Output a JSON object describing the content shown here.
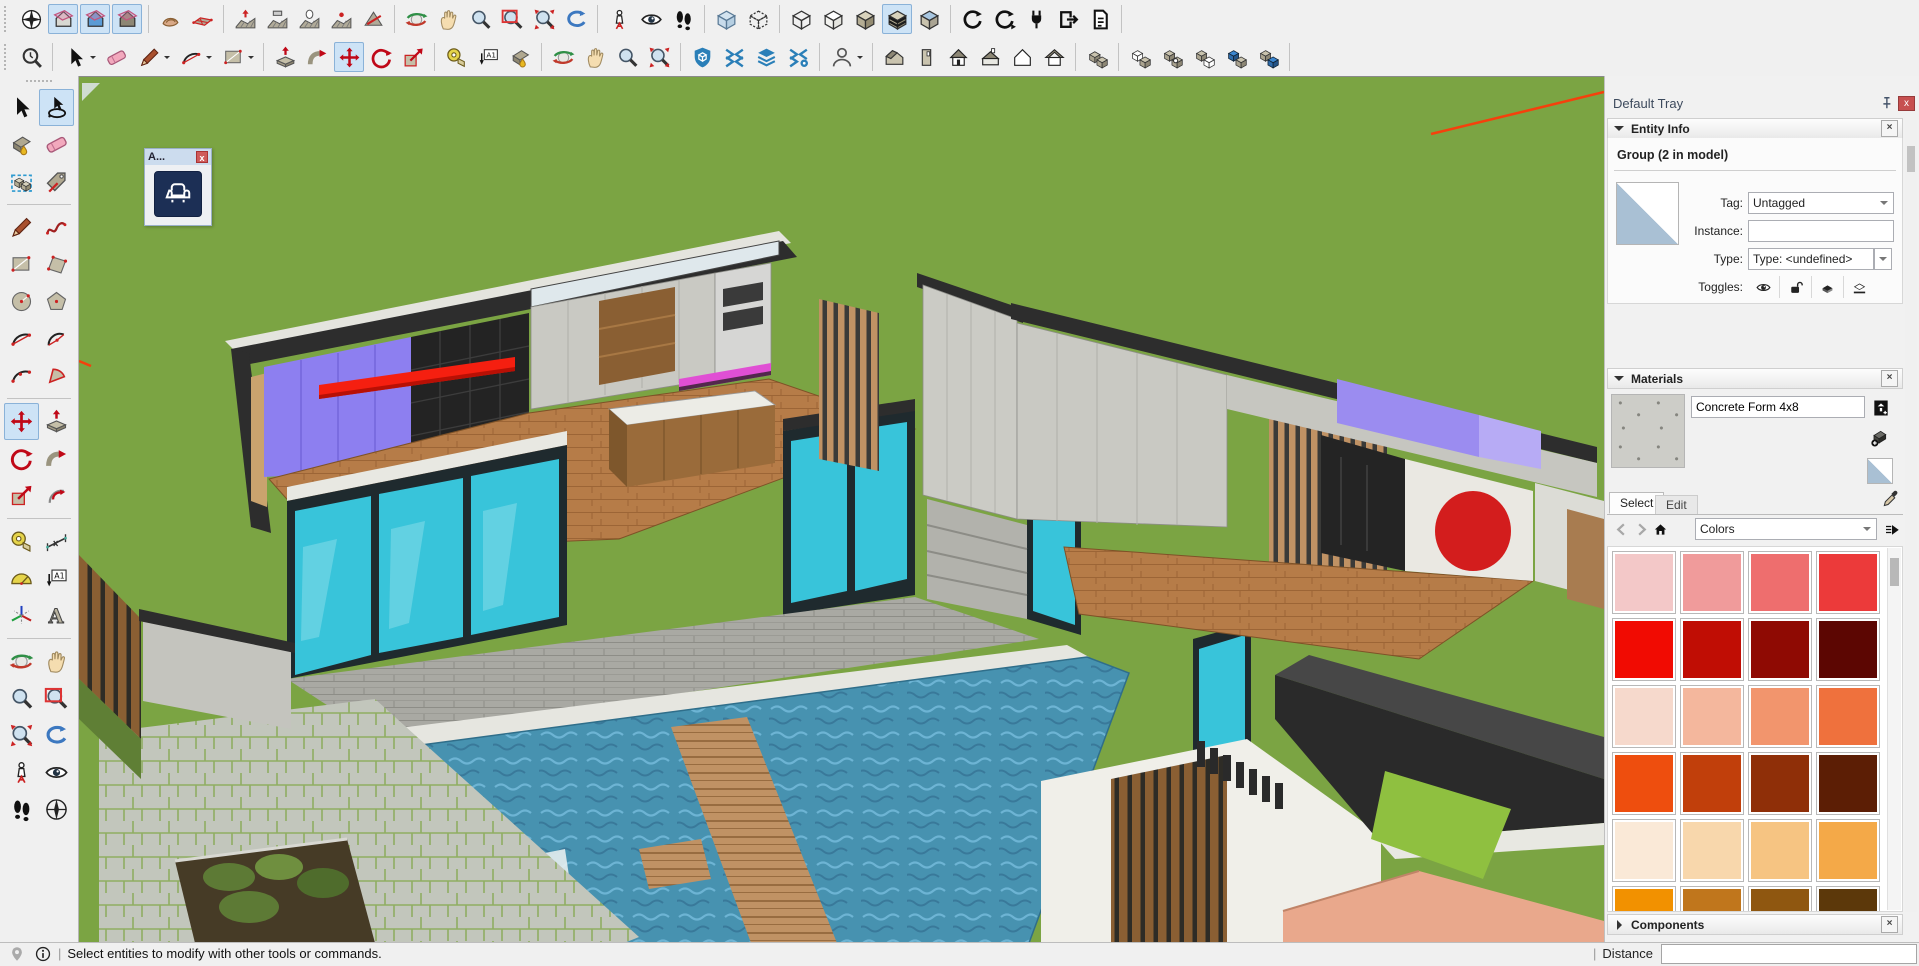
{
  "window": {
    "app": "SketchUp"
  },
  "toolbars": {
    "row1": {
      "items": [
        {
          "icon": "compass"
        },
        {
          "icon": "section-plane",
          "sel": true
        },
        {
          "icon": "section-cuts",
          "sel": true
        },
        {
          "icon": "section-fill",
          "sel": true
        },
        {
          "sep": true
        },
        {
          "icon": "sandbox-from-contours"
        },
        {
          "icon": "sandbox-from-scratch"
        },
        {
          "sep": true
        },
        {
          "icon": "smoove"
        },
        {
          "icon": "stamp"
        },
        {
          "icon": "drape"
        },
        {
          "icon": "add-detail"
        },
        {
          "icon": "flip-edge"
        },
        {
          "sep": true
        },
        {
          "icon": "orbit"
        },
        {
          "icon": "pan"
        },
        {
          "icon": "zoom"
        },
        {
          "icon": "zoom-window"
        },
        {
          "icon": "zoom-extents"
        },
        {
          "icon": "previous-view"
        },
        {
          "sep": true
        },
        {
          "icon": "position-camera"
        },
        {
          "icon": "look-around"
        },
        {
          "icon": "walk"
        },
        {
          "sep": true
        },
        {
          "icon": "xray"
        },
        {
          "icon": "back-edges"
        },
        {
          "sep": true
        },
        {
          "icon": "wireframe"
        },
        {
          "icon": "hidden-line"
        },
        {
          "icon": "shaded"
        },
        {
          "icon": "shaded-textures",
          "sel": true
        },
        {
          "icon": "monochrome"
        },
        {
          "sep": true
        },
        {
          "icon": "sync"
        },
        {
          "icon": "sync-run"
        },
        {
          "icon": "plugin"
        },
        {
          "icon": "export"
        },
        {
          "icon": "report"
        },
        {
          "sep": true
        }
      ]
    },
    "row2": {
      "items": [
        {
          "icon": "search"
        },
        {
          "sep": true
        },
        {
          "icon": "select",
          "caret": true
        },
        {
          "icon": "eraser"
        },
        {
          "icon": "line",
          "caret": true
        },
        {
          "icon": "arc-2pt",
          "caret": true
        },
        {
          "icon": "rectangle",
          "caret": true
        },
        {
          "sep": true
        },
        {
          "icon": "push-pull"
        },
        {
          "icon": "follow-me"
        },
        {
          "icon": "move",
          "sel": true
        },
        {
          "icon": "rotate"
        },
        {
          "icon": "scale"
        },
        {
          "sep": true
        },
        {
          "icon": "tape-measure"
        },
        {
          "icon": "text"
        },
        {
          "icon": "paint-bucket"
        },
        {
          "sep": true
        },
        {
          "icon": "orbit"
        },
        {
          "icon": "pan"
        },
        {
          "icon": "zoom"
        },
        {
          "icon": "zoom-extents"
        },
        {
          "sep": true
        },
        {
          "icon": "ext-shield"
        },
        {
          "icon": "ext-swap"
        },
        {
          "icon": "ext-layers"
        },
        {
          "icon": "ext-gear"
        },
        {
          "sep": true
        },
        {
          "icon": "person",
          "caret": true
        },
        {
          "sep": true
        },
        {
          "icon": "view-iso"
        },
        {
          "icon": "view-right"
        },
        {
          "icon": "view-front"
        },
        {
          "icon": "view-top"
        },
        {
          "icon": "view-back"
        },
        {
          "icon": "view-left"
        },
        {
          "sep": true
        },
        {
          "icon": "cubes-edit"
        },
        {
          "sep": true
        },
        {
          "icon": "cubes-a"
        },
        {
          "icon": "cubes-b"
        },
        {
          "icon": "cubes-c"
        },
        {
          "icon": "cubes-d"
        },
        {
          "icon": "cubes-e"
        },
        {
          "sep": true
        }
      ]
    },
    "left": {
      "rows": [
        {
          "l": {
            "icon": "select"
          },
          "r": {
            "icon": "lasso",
            "sel": true
          }
        },
        {
          "l": {
            "icon": "paint-bucket"
          },
          "r": {
            "icon": "eraser"
          }
        },
        {
          "l": {
            "icon": "make-component"
          },
          "r": {
            "icon": "tag"
          }
        },
        {
          "sep": true
        },
        {
          "l": {
            "icon": "line"
          },
          "r": {
            "icon": "freehand"
          }
        },
        {
          "l": {
            "icon": "rectangle"
          },
          "r": {
            "icon": "rotated-rectangle"
          }
        },
        {
          "l": {
            "icon": "circle"
          },
          "r": {
            "icon": "polygon"
          }
        },
        {
          "l": {
            "icon": "arc-2pt"
          },
          "r": {
            "icon": "arc"
          }
        },
        {
          "l": {
            "icon": "arc-3pt"
          },
          "r": {
            "icon": "pie"
          }
        },
        {
          "sep": true
        },
        {
          "l": {
            "icon": "move",
            "sel": true
          },
          "r": {
            "icon": "push-pull"
          }
        },
        {
          "l": {
            "icon": "rotate"
          },
          "r": {
            "icon": "follow-me"
          }
        },
        {
          "l": {
            "icon": "scale"
          },
          "r": {
            "icon": "offset"
          }
        },
        {
          "sep": true
        },
        {
          "l": {
            "icon": "tape-measure"
          },
          "r": {
            "icon": "dimension"
          }
        },
        {
          "l": {
            "icon": "protractor"
          },
          "r": {
            "icon": "text"
          }
        },
        {
          "l": {
            "icon": "axes"
          },
          "r": {
            "icon": "3d-text"
          }
        },
        {
          "sep": true
        },
        {
          "l": {
            "icon": "orbit"
          },
          "r": {
            "icon": "pan"
          }
        },
        {
          "l": {
            "icon": "zoom"
          },
          "r": {
            "icon": "zoom-window"
          }
        },
        {
          "l": {
            "icon": "zoom-extents"
          },
          "r": {
            "icon": "previous-view"
          }
        },
        {
          "l": {
            "icon": "position-camera"
          },
          "r": {
            "icon": "look-around"
          }
        },
        {
          "l": {
            "icon": "walk"
          },
          "r": {
            "icon": "north-compass"
          }
        }
      ]
    }
  },
  "floating_toolbar": {
    "title": "A...",
    "button_icon": "armchair-icon"
  },
  "tray": {
    "title": "Default Tray",
    "entity_info": {
      "title": "Entity Info",
      "group_summary": "Group (2 in model)",
      "tag_label": "Tag:",
      "tag_value": "Untagged",
      "instance_label": "Instance:",
      "instance_value": "",
      "type_label": "Type:",
      "type_value": "Type: <undefined>",
      "toggles_label": "Toggles:",
      "toggle_icons": [
        "visible-eye-icon",
        "unlocked-icon",
        "cast-shadows-icon",
        "receive-shadows-icon"
      ]
    },
    "materials": {
      "title": "Materials",
      "material_name": "Concrete Form 4x8",
      "tab_select": "Select",
      "tab_edit": "Edit",
      "active_tab": "Select",
      "collection_value": "Colors",
      "swatches": [
        "#f3c8c8",
        "#f09b9b",
        "#ee6e6e",
        "#ec3a3a",
        "#f10b02",
        "#c00d04",
        "#8f0a03",
        "#5c0602",
        "#f6d9cc",
        "#f4b79d",
        "#f2956d",
        "#ef713d",
        "#ee4e0e",
        "#c13f0b",
        "#8f2f08",
        "#5c1e05",
        "#fae9d7",
        "#f8d7ac",
        "#f6c482",
        "#f4a948",
        "#f29100",
        "#c0761c",
        "#8f5710",
        "#5c380a"
      ]
    },
    "components": {
      "title": "Components"
    }
  },
  "status_bar": {
    "message": "Select entities to modify with other tools or commands.",
    "separator": "|",
    "distance_label": "Distance",
    "distance_value": ""
  },
  "colors": {
    "selection_highlight": "#cde3f6",
    "grass": "#7ba443",
    "pool_water": "#4792b0",
    "wall_cap": "#2d2d2d",
    "concrete": "#c9c9c3",
    "glass_teal": "#38c4da",
    "wood_floor": "#b67c48",
    "accent_red_axis": "#f5400c"
  }
}
